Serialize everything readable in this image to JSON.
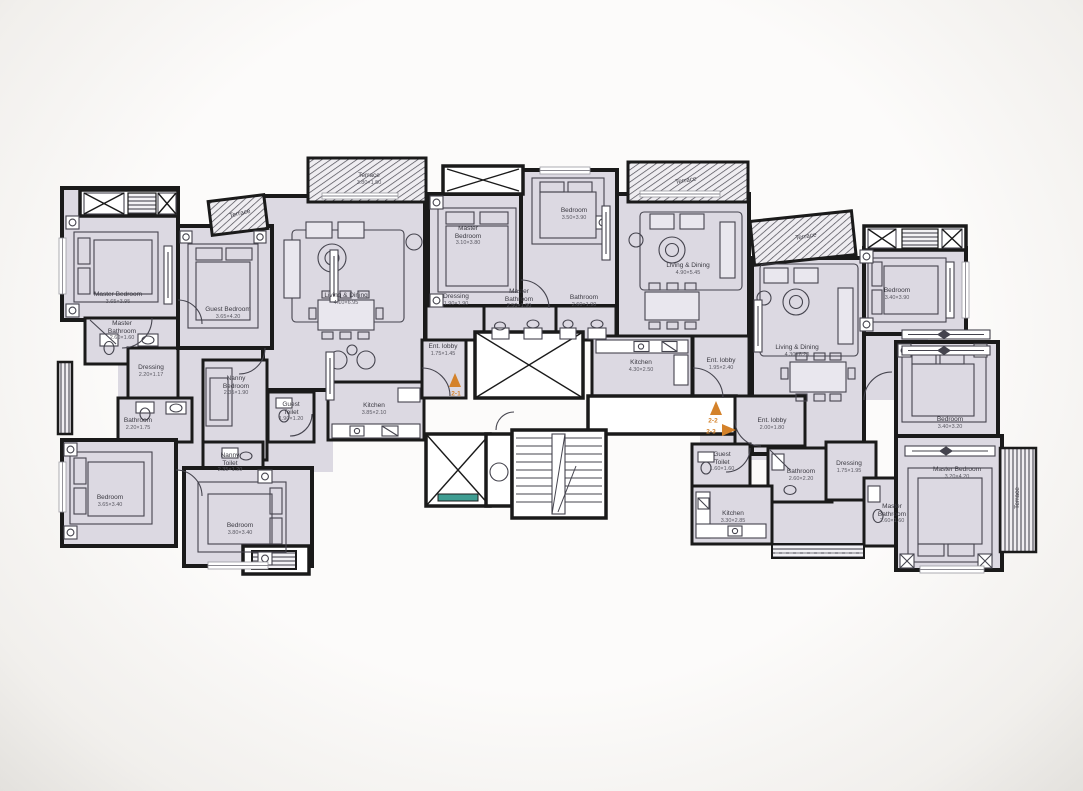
{
  "document": {
    "type": "architectural floor plan",
    "description": "Scanned residential floor plan with three apartment units around a central lift and stair core"
  },
  "colors": {
    "room_fill": "#dcd9e2",
    "wall": "#1a1a1a",
    "unit_marker_accent": "#d4822a",
    "lift_accent": "#3f9d92"
  },
  "unit_markers": {
    "u1": "2-1",
    "u2": "2-2",
    "u3": "2-3"
  },
  "rooms": [
    {
      "name": "Master Bedroom",
      "dims": "3.65×3.95"
    },
    {
      "name": "Master Bathroom",
      "dims": "2.60×1.60"
    },
    {
      "name": "Dressing",
      "dims": "2.20×1.17"
    },
    {
      "name": "Bathroom",
      "dims": "2.20×1.75"
    },
    {
      "name": "Bedroom",
      "dims": "3.65×3.40"
    },
    {
      "name": "Guest Bedroom",
      "dims": "3.65×4.20"
    },
    {
      "name": "Nanny Bedroom",
      "dims": "2.35×1.90"
    },
    {
      "name": "Nanny Toilet",
      "dims": "2.35×1.20"
    },
    {
      "name": "Bedroom",
      "dims": "3.80×3.40"
    },
    {
      "name": "Guest Toilet",
      "dims": "1.90×1.20"
    },
    {
      "name": "Kitchen",
      "dims": "3.85×2.10"
    },
    {
      "name": "Living & Dining",
      "dims": "4.10×6.95"
    },
    {
      "name": "Terrace",
      "dims": "3.80×1.50"
    },
    {
      "name": "Terrace",
      "dims": ""
    },
    {
      "name": "Master Bedroom",
      "dims": "3.10×3.80"
    },
    {
      "name": "Bedroom",
      "dims": "3.50×3.90"
    },
    {
      "name": "Dressing",
      "dims": "1.90×1.90"
    },
    {
      "name": "Master Bathroom",
      "dims": "2.50×1.90"
    },
    {
      "name": "Bathroom",
      "dims": "2.60×1.90"
    },
    {
      "name": "Ent. lobby",
      "dims": "1.75×1.45"
    },
    {
      "name": "Kitchen",
      "dims": "4.30×2.50"
    },
    {
      "name": "Living & Dining",
      "dims": "4.90×5.45"
    },
    {
      "name": "Terrace",
      "dims": ""
    },
    {
      "name": "Ent. lobby",
      "dims": "1.95×2.40"
    },
    {
      "name": "Ent. lobby",
      "dims": "2.00×1.80"
    },
    {
      "name": "Guest Toilet",
      "dims": "1.60×1.60"
    },
    {
      "name": "Kitchen",
      "dims": "3.30×2.85"
    },
    {
      "name": "Bathroom",
      "dims": "2.60×2.20"
    },
    {
      "name": "Dressing",
      "dims": "1.75×1.95"
    },
    {
      "name": "Living & Dining",
      "dims": "4.30×6.20"
    },
    {
      "name": "Terrace",
      "dims": ""
    },
    {
      "name": "Bedroom",
      "dims": "3.40×3.90"
    },
    {
      "name": "Bedroom",
      "dims": "3.40×3.20"
    },
    {
      "name": "Master Bedroom",
      "dims": "3.20×4.20"
    },
    {
      "name": "Master Bathroom",
      "dims": "2.60×1.60"
    },
    {
      "name": "Terrace",
      "dims": ""
    }
  ]
}
